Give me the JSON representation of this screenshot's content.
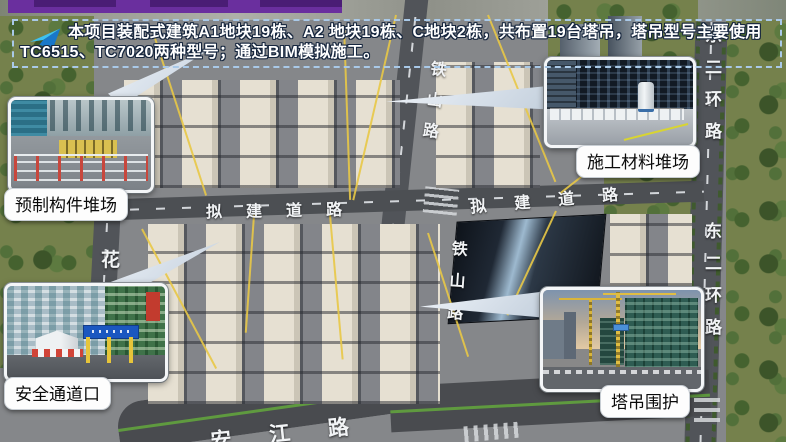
{
  "banner": {
    "line1": "本项目装配式建筑A1地块19栋、A2 地块19栋、C地块2栋，共布置19台塔吊，塔吊型号主要使用",
    "line2": "TC6515、TC7020两种型号；通过BIM模拟施工。",
    "icon": "paper-plane-arrow"
  },
  "callouts": {
    "precast": {
      "label": "预制构件堆场"
    },
    "materials": {
      "label": "施工材料堆场"
    },
    "safety": {
      "label": "安全通道口"
    },
    "crane": {
      "label": "塔吊围护"
    }
  },
  "roads": {
    "tieshan": "铁山路",
    "nijian": "拟建道路",
    "donger": "东二环路",
    "hua": "花",
    "anjiang": "安江路"
  },
  "colors": {
    "accent_purple": "#6A2F9E",
    "banner_border": "#A9C9E8",
    "banner_text": "#FFFFFF",
    "crane_line_yellow": "#E8C846",
    "label_bg": "#FDFDFD",
    "label_text": "#0A0A0A"
  }
}
